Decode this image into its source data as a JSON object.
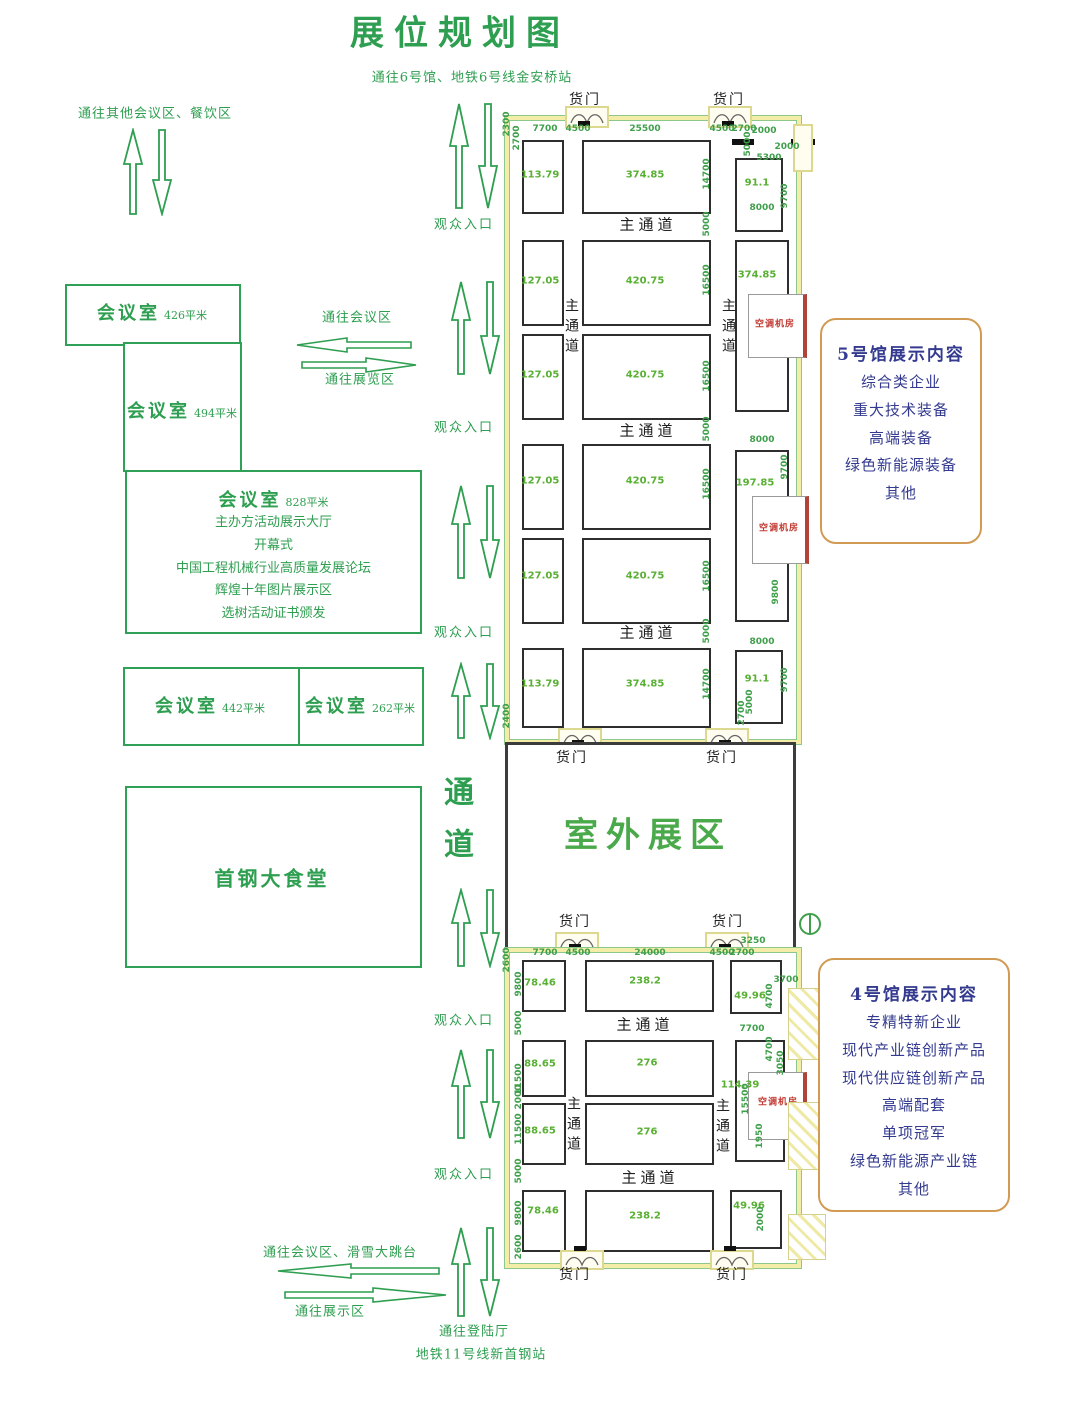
{
  "title": "展位规划图",
  "subtitle": "通往6号馆、地铁6号线金安桥站",
  "left": {
    "note_top": "通往其他会议区、餐饮区",
    "to_meeting": "通往会议区",
    "to_exhibit": "通往展览区",
    "to_meeting_ski": "通往会议区、滑雪大跳台",
    "to_display": "通往展示区",
    "rooms": {
      "r426": {
        "label": "会议室",
        "area": "426平米"
      },
      "r494": {
        "label": "会议室",
        "area": "494平米"
      },
      "r828": {
        "label": "会议室",
        "area": "828平米",
        "lines": [
          "主办方活动展示大厅",
          "开幕式",
          "中国工程机械行业高质量发展论坛",
          "辉煌十年图片展示区",
          "选树活动证书颁发"
        ]
      },
      "r442": {
        "label": "会议室",
        "area": "442平米"
      },
      "r262": {
        "label": "会议室",
        "area": "262平米"
      },
      "canteen": "首钢大食堂"
    }
  },
  "corridor": {
    "channel": "通道",
    "entrance": "观众入口",
    "to_hall": "通往登陆厅",
    "metro": "地铁11号线新首钢站"
  },
  "outdoor": {
    "label": "室外展区"
  },
  "common": {
    "cargo_door": "货门",
    "main_aisle": "主通道",
    "ac_room": "空调机房"
  },
  "hall5": {
    "info_title": "5号馆展示内容",
    "info_lines": [
      "综合类企业",
      "重大技术装备",
      "高端装备",
      "绿色新能源装备",
      "其他"
    ],
    "booths": [
      "113.79",
      "374.85",
      "91.1",
      "127.05",
      "420.75",
      "374.85",
      "127.05",
      "420.75",
      "127.05",
      "420.75",
      "197.85",
      "127.05",
      "420.75",
      "113.79",
      "374.85",
      "91.1"
    ],
    "dims": [
      "2300",
      "2700",
      "7700",
      "4500",
      "25500",
      "4500",
      "2700",
      "2000",
      "5000",
      "5300",
      "2000",
      "9700",
      "8000",
      "14700",
      "5000",
      "16500",
      "16500",
      "5000",
      "16500",
      "16500",
      "5000",
      "14700",
      "8000",
      "9700",
      "8000",
      "9700",
      "9800",
      "2400",
      "2700",
      "5000"
    ]
  },
  "hall4": {
    "info_title": "4号馆展示内容",
    "info_lines": [
      "专精特新企业",
      "现代产业链创新产品",
      "现代供应链创新产品",
      "高端配套",
      "单项冠军",
      "绿色新能源产业链",
      "其他"
    ],
    "booths": [
      "78.46",
      "238.2",
      "49.96",
      "88.65",
      "276",
      "114.39",
      "88.65",
      "276",
      "78.46",
      "238.2",
      "49.96"
    ],
    "dims": [
      "2600",
      "7700",
      "4500",
      "24000",
      "4500",
      "2700",
      "3250",
      "3700",
      "9800",
      "4700",
      "5000",
      "7700",
      "4700",
      "11500",
      "2000",
      "11500",
      "15500",
      "3050",
      "1950",
      "5000",
      "9800",
      "2000",
      "2600"
    ]
  }
}
